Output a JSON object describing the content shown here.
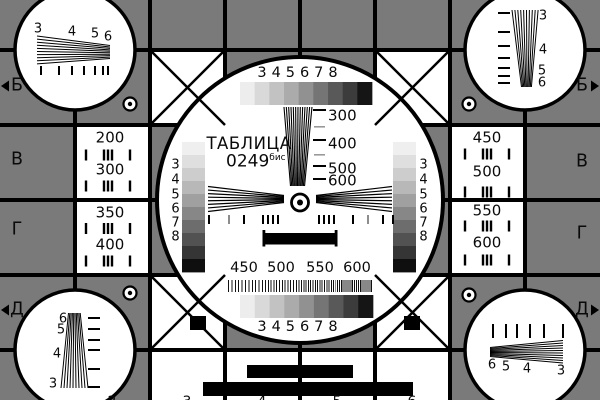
{
  "card": {
    "title": "ТАБЛИЦА",
    "number": "0249",
    "number_suffix": "бис",
    "colors": {
      "background_gray": "#7a7a7a",
      "line_black": "#000000",
      "panel_white": "#ffffff",
      "grayscale_steps": [
        "#ededed",
        "#d9d9d9",
        "#c2c2c2",
        "#ababab",
        "#919191",
        "#757575",
        "#595959",
        "#3c3c3c",
        "#151515"
      ],
      "side_scale_steps": [
        "#efefef",
        "#dfdfdf",
        "#cdcdcd",
        "#b8b8b8",
        "#a0a0a0",
        "#878787",
        "#6d6d6d",
        "#525252",
        "#353535",
        "#0f0f0f"
      ]
    }
  },
  "edge_markers": {
    "left": [
      {
        "label": "Б",
        "arrow": true
      },
      {
        "label": "В",
        "arrow": false
      },
      {
        "label": "Г",
        "arrow": false
      },
      {
        "label": "Д",
        "arrow": true
      }
    ],
    "right": [
      {
        "label": "Б",
        "arrow": true
      },
      {
        "label": "В",
        "arrow": false
      },
      {
        "label": "Г",
        "arrow": false
      },
      {
        "label": "Д",
        "arrow": true
      }
    ],
    "top_digits": [
      "2",
      "3",
      "4",
      "5",
      "6"
    ],
    "bottom_digits": [
      "2",
      "3",
      "4",
      "5",
      "6"
    ]
  },
  "resolution_cells": {
    "left": [
      "200",
      "300",
      "350",
      "400"
    ],
    "right": [
      "450",
      "500",
      "550",
      "600"
    ]
  },
  "grayscale_labels": [
    "3",
    "4",
    "5",
    "6",
    "7",
    "8"
  ],
  "side_scale_labels": [
    "3",
    "4",
    "5",
    "6",
    "7",
    "8"
  ],
  "center_wedge_labels": [
    "300",
    "400",
    "500",
    "600"
  ],
  "definition_band_labels": [
    "450",
    "500",
    "550",
    "600"
  ],
  "corner_circles": {
    "top_left_labels": [
      "3",
      "4",
      "5",
      "6"
    ],
    "top_right_labels": [
      "3",
      "4",
      "5",
      "6"
    ],
    "bottom_left_labels": [
      "6",
      "5",
      "4",
      "3"
    ],
    "bottom_right_labels": [
      "6",
      "5",
      "4",
      "3"
    ]
  }
}
